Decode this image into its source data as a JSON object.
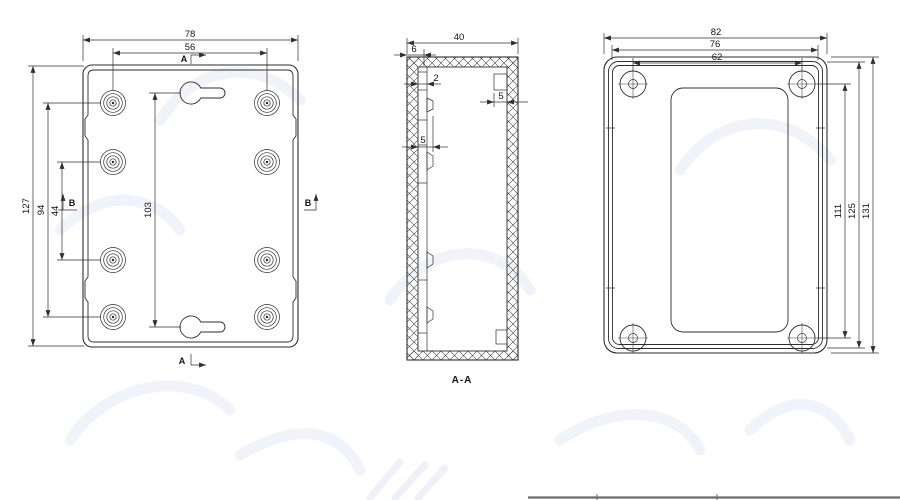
{
  "back": {
    "dim_width": "78",
    "dim_cols": "56",
    "dim_height": "127",
    "dim_rows_outer": "94",
    "dim_rows_inner": "44",
    "dim_keyholes": "103",
    "section_a": "A",
    "section_b": "B"
  },
  "section": {
    "dim_depth": "40",
    "dim_rib": "6",
    "dim_wall": "2",
    "dim_boss_left": "5",
    "dim_boss_right": "5",
    "label": "A-A"
  },
  "front": {
    "dim_width": "82",
    "dim_lid": "76",
    "dim_cols": "62",
    "dim_rows": "111",
    "dim_lid_h": "125",
    "dim_height": "131"
  },
  "colors": {
    "line": "#2d2d2d",
    "background": "#ffffff"
  }
}
